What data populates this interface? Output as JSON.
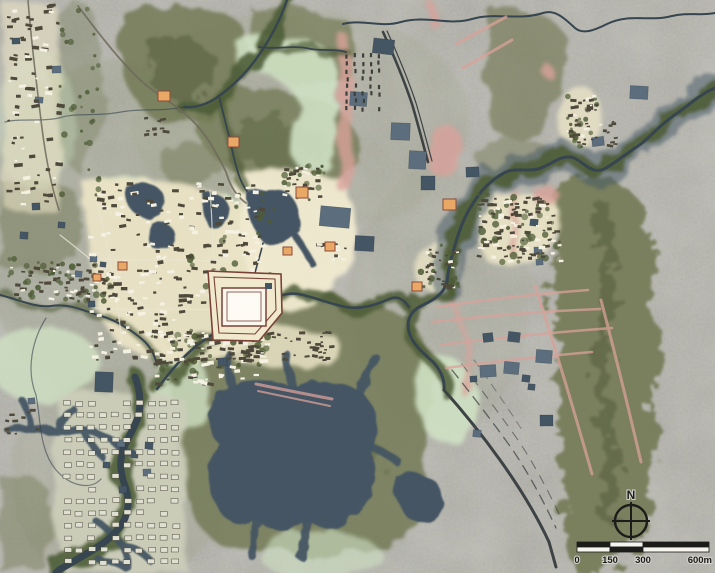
{
  "title": "archaeological-landscape-map",
  "compass": {
    "north_label": "N"
  },
  "scalebar": {
    "labels": [
      {
        "text": "0",
        "frac": 0,
        "anchor": "middle"
      },
      {
        "text": "150",
        "frac": 0.25,
        "anchor": "middle"
      },
      {
        "text": "300",
        "frac": 0.5,
        "anchor": "middle"
      },
      {
        "text": "600m",
        "frac": 1,
        "anchor": "end"
      }
    ],
    "fracs": [
      0,
      0.25,
      0.5,
      1
    ],
    "rows": [
      [
        "dark",
        "light",
        "dark"
      ],
      [
        "light",
        "dark",
        "light"
      ]
    ]
  },
  "colors": {
    "base": "#a9a8a2",
    "sage": "#9aa084",
    "hill": "#737a55",
    "hill_dark": "#596140",
    "tree": "#4e5c36",
    "marsh": "#cfe1c3",
    "cream": "#eae3c5",
    "plain": "#f0ead0",
    "gridbase": "#cbcdb9",
    "water": "#445564",
    "water_dark": "#36454f",
    "pond": "#5c6e7e",
    "pink": "#d9a29a",
    "road": "#6e6a5c",
    "rail": "#3d4244",
    "ink": "#1c1c1a",
    "building_dark": "#4e493b",
    "building_light": "#f4f0e2",
    "temple_fill": "#eaa866",
    "temple_stroke": "#8a4a36",
    "wall": "#7a4138",
    "wall_fill": "#f0e9cd",
    "inner_fill": "#faf7ec"
  },
  "map": {
    "ponds": [
      {
        "x": 32,
        "y": 203,
        "w": 8,
        "h": 7
      },
      {
        "x": 20,
        "y": 232,
        "w": 8,
        "h": 7
      },
      {
        "x": 90,
        "y": 256,
        "w": 7,
        "h": 6
      },
      {
        "x": 100,
        "y": 262,
        "w": 6,
        "h": 5
      },
      {
        "x": 75,
        "y": 271,
        "w": 7,
        "h": 6
      },
      {
        "x": 88,
        "y": 301,
        "w": 7,
        "h": 6
      },
      {
        "x": 95,
        "y": 372,
        "w": 18,
        "h": 20
      },
      {
        "x": 52,
        "y": 66,
        "w": 9,
        "h": 7
      },
      {
        "x": 12,
        "y": 38,
        "w": 8,
        "h": 6
      },
      {
        "x": 35,
        "y": 97,
        "w": 8,
        "h": 6
      },
      {
        "x": 58,
        "y": 222,
        "w": 7,
        "h": 6
      },
      {
        "x": 350,
        "y": 92,
        "w": 17,
        "h": 14
      },
      {
        "x": 391,
        "y": 123,
        "w": 19,
        "h": 17
      },
      {
        "x": 409,
        "y": 151,
        "w": 17,
        "h": 18
      },
      {
        "x": 421,
        "y": 176,
        "w": 14,
        "h": 14
      },
      {
        "x": 373,
        "y": 39,
        "w": 21,
        "h": 15
      },
      {
        "x": 320,
        "y": 207,
        "w": 30,
        "h": 20
      },
      {
        "x": 355,
        "y": 236,
        "w": 19,
        "h": 15
      },
      {
        "x": 466,
        "y": 167,
        "w": 13,
        "h": 10
      },
      {
        "x": 630,
        "y": 86,
        "w": 18,
        "h": 13
      },
      {
        "x": 592,
        "y": 137,
        "w": 12,
        "h": 9
      },
      {
        "x": 530,
        "y": 219,
        "w": 8,
        "h": 7
      },
      {
        "x": 534,
        "y": 247,
        "w": 8,
        "h": 7
      },
      {
        "x": 536,
        "y": 259,
        "w": 7,
        "h": 6
      },
      {
        "x": 480,
        "y": 365,
        "w": 16,
        "h": 12
      },
      {
        "x": 504,
        "y": 362,
        "w": 15,
        "h": 12
      },
      {
        "x": 536,
        "y": 350,
        "w": 16,
        "h": 13
      },
      {
        "x": 508,
        "y": 332,
        "w": 12,
        "h": 10
      },
      {
        "x": 483,
        "y": 333,
        "w": 10,
        "h": 9
      },
      {
        "x": 470,
        "y": 376,
        "w": 7,
        "h": 6
      },
      {
        "x": 522,
        "y": 375,
        "w": 8,
        "h": 7
      },
      {
        "x": 528,
        "y": 384,
        "w": 7,
        "h": 6
      },
      {
        "x": 540,
        "y": 415,
        "w": 13,
        "h": 11
      },
      {
        "x": 473,
        "y": 430,
        "w": 8,
        "h": 7
      },
      {
        "x": 117,
        "y": 440,
        "w": 8,
        "h": 7
      },
      {
        "x": 145,
        "y": 442,
        "w": 8,
        "h": 7
      },
      {
        "x": 103,
        "y": 462,
        "w": 7,
        "h": 6
      },
      {
        "x": 143,
        "y": 469,
        "w": 8,
        "h": 7
      },
      {
        "x": 131,
        "y": 452,
        "w": 7,
        "h": 6
      },
      {
        "x": 119,
        "y": 486,
        "w": 8,
        "h": 7
      },
      {
        "x": 218,
        "y": 358,
        "w": 9,
        "h": 8
      },
      {
        "x": 28,
        "y": 398,
        "w": 7,
        "h": 6
      }
    ],
    "temples": [
      {
        "x": 158,
        "y": 91,
        "w": 12,
        "h": 10
      },
      {
        "x": 228,
        "y": 137,
        "w": 11,
        "h": 10
      },
      {
        "x": 296,
        "y": 187,
        "w": 12,
        "h": 11
      },
      {
        "x": 325,
        "y": 242,
        "w": 10,
        "h": 9
      },
      {
        "x": 283,
        "y": 247,
        "w": 9,
        "h": 8
      },
      {
        "x": 412,
        "y": 282,
        "w": 10,
        "h": 9
      },
      {
        "x": 443,
        "y": 199,
        "w": 13,
        "h": 11
      },
      {
        "x": 93,
        "y": 274,
        "w": 8,
        "h": 7
      },
      {
        "x": 118,
        "y": 262,
        "w": 9,
        "h": 8
      }
    ],
    "building_clusters": [
      {
        "name": "town-core",
        "type": "scatter",
        "x": 86,
        "y": 182,
        "w": 176,
        "h": 180,
        "count": 270,
        "size": 3,
        "light": 0.45,
        "seed": 11
      },
      {
        "name": "town-south",
        "type": "scatter",
        "x": 150,
        "y": 330,
        "w": 115,
        "h": 55,
        "count": 70,
        "size": 3,
        "light": 0.4,
        "seed": 12
      },
      {
        "name": "left-strip",
        "type": "scatter",
        "x": 6,
        "y": 4,
        "w": 52,
        "h": 205,
        "count": 80,
        "size": 3,
        "light": 0.35,
        "seed": 13
      },
      {
        "name": "ne-settlement",
        "type": "scatter",
        "x": 477,
        "y": 197,
        "w": 82,
        "h": 64,
        "count": 95,
        "size": 2.6,
        "light": 0.3,
        "seed": 14
      },
      {
        "name": "right-hill-village",
        "type": "scatter",
        "x": 566,
        "y": 94,
        "w": 30,
        "h": 50,
        "count": 32,
        "size": 2.4,
        "light": 0.25,
        "seed": 15
      },
      {
        "name": "ruin-rows",
        "type": "rows",
        "x": 346,
        "y": 54,
        "cols": 5,
        "rows": 8,
        "dx": 8,
        "dy": 7.5,
        "bw": 2.2,
        "bh": 4.2,
        "skip": 0.18,
        "seed": 16
      },
      {
        "name": "hamlet-north",
        "type": "scatter",
        "x": 282,
        "y": 166,
        "w": 36,
        "h": 32,
        "count": 26,
        "size": 2.6,
        "light": 0.2,
        "seed": 17
      },
      {
        "name": "hamlet-river-east",
        "type": "scatter",
        "x": 418,
        "y": 246,
        "w": 38,
        "h": 42,
        "count": 26,
        "size": 2.4,
        "light": 0.25,
        "seed": 18
      },
      {
        "name": "hamlet-mid",
        "type": "scatter",
        "x": 316,
        "y": 236,
        "w": 30,
        "h": 24,
        "count": 14,
        "size": 2.4,
        "light": 0.2,
        "seed": 19
      },
      {
        "name": "shore-ruins",
        "type": "scatter",
        "x": 228,
        "y": 330,
        "w": 105,
        "h": 30,
        "count": 45,
        "size": 2.4,
        "light": 0.15,
        "seed": 20
      },
      {
        "name": "village-west-band",
        "type": "scatter",
        "x": 10,
        "y": 262,
        "w": 100,
        "h": 38,
        "count": 55,
        "size": 2.6,
        "light": 0.35,
        "seed": 21
      },
      {
        "name": "grid-city",
        "type": "grid",
        "x": 64,
        "y": 401,
        "cols": 10,
        "rows": 14,
        "dx": 12,
        "dy": 12.2,
        "bw": 7,
        "bh": 4.6,
        "skip": 0.13,
        "seed": 22
      },
      {
        "name": "hamlet-nw",
        "type": "scatter",
        "x": 142,
        "y": 116,
        "w": 22,
        "h": 18,
        "count": 9,
        "size": 2.4,
        "light": 0.1,
        "seed": 23
      },
      {
        "name": "hamlet-sw-river",
        "type": "scatter",
        "x": 2,
        "y": 408,
        "w": 38,
        "h": 26,
        "count": 10,
        "size": 2.2,
        "light": 0.2,
        "seed": 24
      },
      {
        "name": "riverside-hamlets-ne",
        "type": "scatter",
        "x": 598,
        "y": 120,
        "w": 20,
        "h": 26,
        "count": 10,
        "size": 2.2,
        "light": 0.2,
        "seed": 25
      }
    ],
    "tree_clusters": [
      {
        "x": 8,
        "y": 258,
        "w": 108,
        "h": 44,
        "count": 45,
        "size": 2.8,
        "seed": 31
      },
      {
        "x": 478,
        "y": 192,
        "w": 80,
        "h": 70,
        "count": 40,
        "size": 3.2,
        "seed": 32
      },
      {
        "x": 186,
        "y": 192,
        "w": 88,
        "h": 115,
        "count": 40,
        "size": 2.8,
        "seed": 33
      },
      {
        "x": 150,
        "y": 330,
        "w": 120,
        "h": 45,
        "count": 30,
        "size": 2.8,
        "seed": 34
      },
      {
        "x": 284,
        "y": 165,
        "w": 40,
        "h": 35,
        "count": 18,
        "size": 2.6,
        "seed": 35
      },
      {
        "x": 420,
        "y": 244,
        "w": 40,
        "h": 45,
        "count": 18,
        "size": 2.8,
        "seed": 36
      },
      {
        "x": 564,
        "y": 92,
        "w": 34,
        "h": 55,
        "count": 20,
        "size": 2.6,
        "seed": 37
      },
      {
        "x": 60,
        "y": 0,
        "w": 40,
        "h": 200,
        "count": 30,
        "size": 2.6,
        "seed": 38
      }
    ],
    "pink_bands": [
      {
        "d": "M341,38 Q352,66 344,96 Q337,124 348,152 Q352,170 344,186",
        "w": 13
      },
      {
        "d": "M437,128 Q455,120 463,140 Q468,162 452,178 Q436,184 428,166 Q424,142 437,128",
        "w": 0
      },
      {
        "d": "M533,186 Q552,182 562,196 Q558,208 540,206 Q530,198 533,186",
        "w": 0
      },
      {
        "d": "M428,2 Q436,12 434,24",
        "w": 8
      },
      {
        "d": "M543,60 Q554,64 551,76 Q542,78 538,68 Z",
        "w": 0
      },
      {
        "d": "M449,298 Q468,330 470,368 Q469,385 466,395",
        "w": 5
      },
      {
        "d": "M512,190 Q515,222 512,253",
        "w": 5
      }
    ],
    "pink_lines": [
      {
        "d": "M437,307 Q510,296 588,290",
        "w": 2.5
      },
      {
        "d": "M433,322 Q520,312 600,309",
        "w": 2.5
      },
      {
        "d": "M440,345 Q530,334 612,328",
        "w": 2.5
      },
      {
        "d": "M446,368 Q520,358 592,352",
        "w": 2.5
      },
      {
        "d": "M535,286 Q562,368 592,474",
        "w": 3
      },
      {
        "d": "M601,300 Q622,380 641,462",
        "w": 3
      },
      {
        "d": "M456,44 L506,17",
        "w": 3
      },
      {
        "d": "M463,68 L512,40",
        "w": 3
      },
      {
        "d": "M256,384 Q295,392 332,399",
        "w": 3
      },
      {
        "d": "M258,391 Q296,399 330,406",
        "w": 2
      }
    ]
  }
}
